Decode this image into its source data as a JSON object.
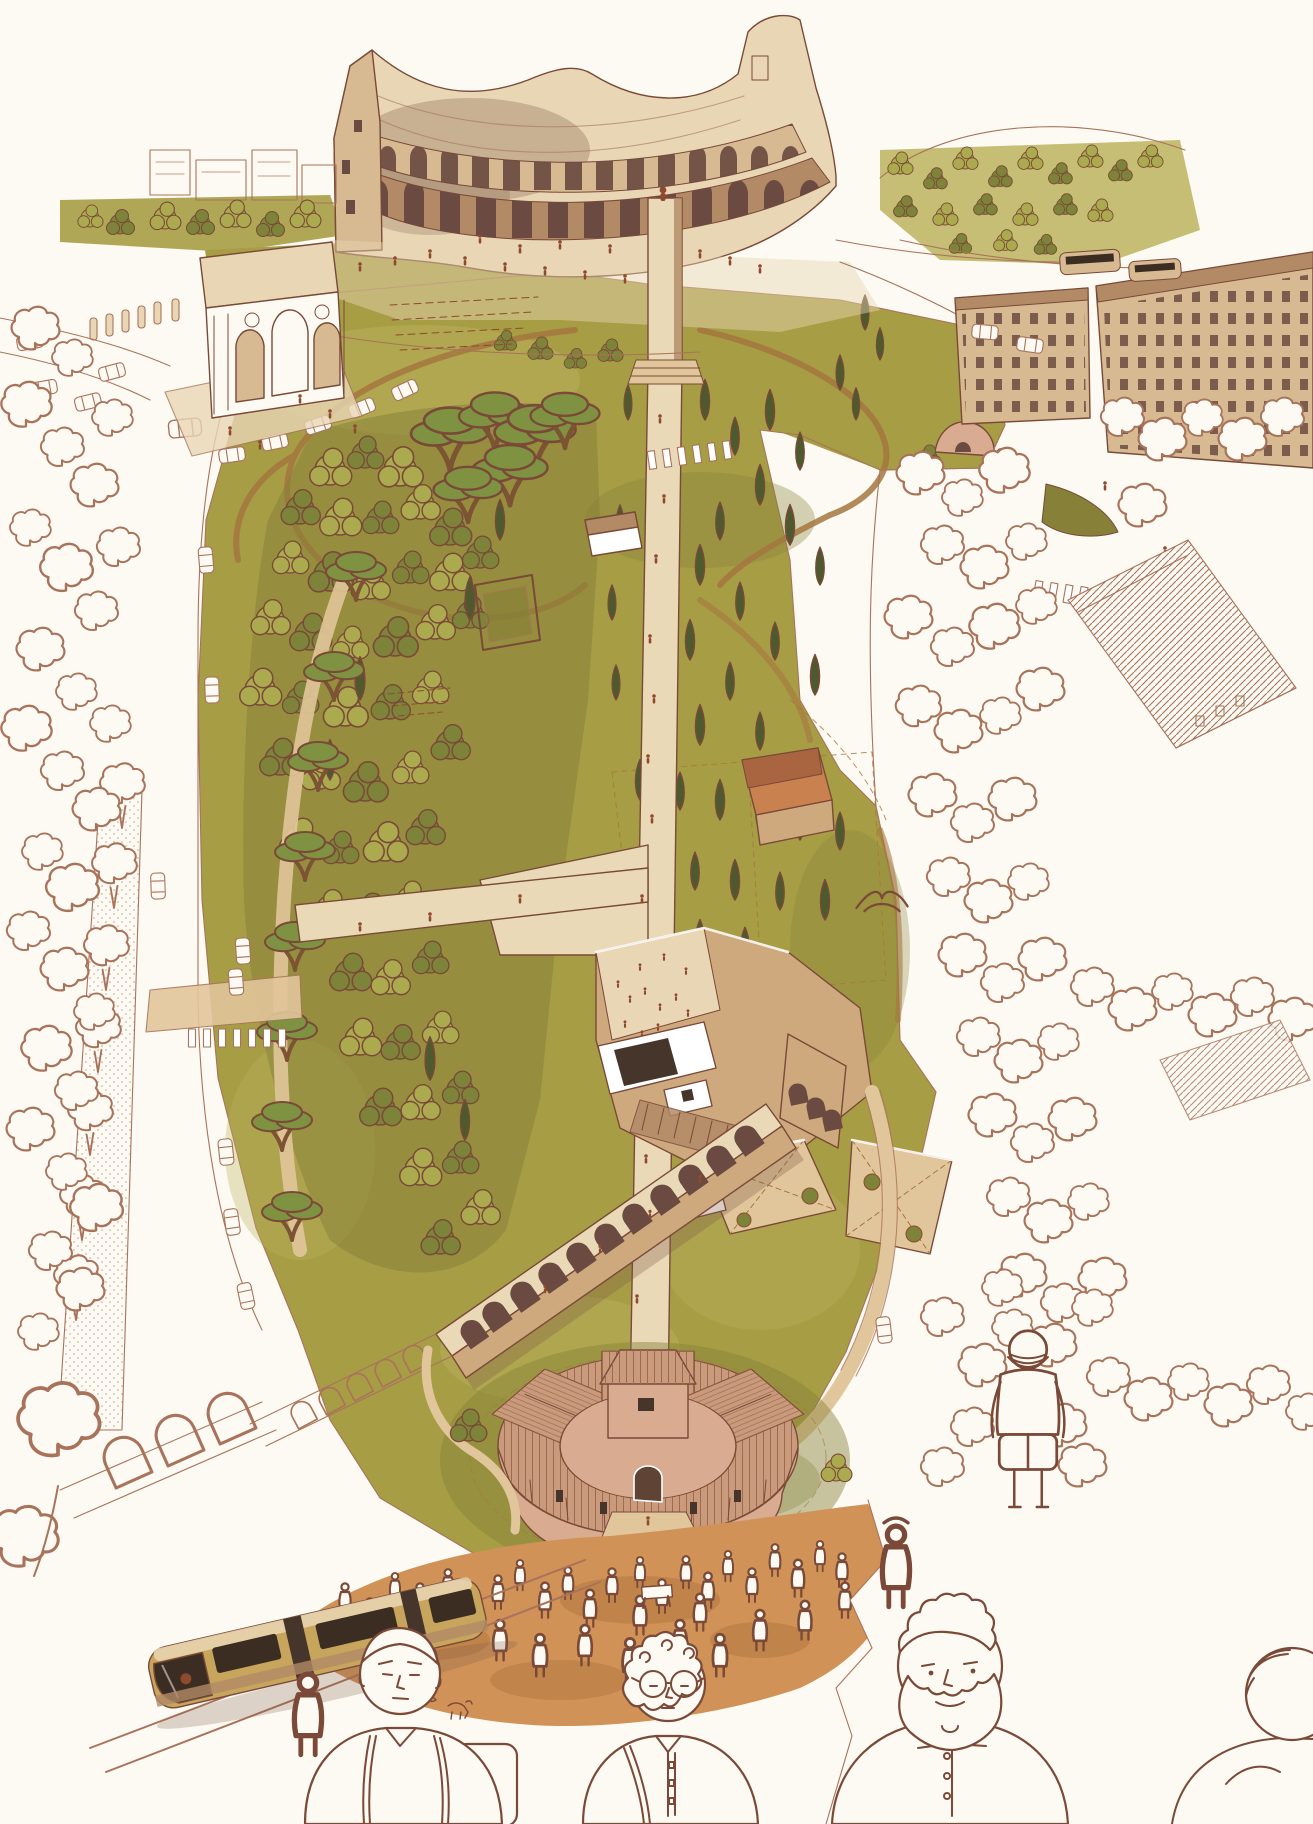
{
  "artwork": {
    "medium": "ink and watercolor aerial illustration",
    "view": "bird's-eye view, partially uncolored line art at the edges",
    "subject": "Archaeological park at the Colosseum in Rome",
    "visible_text": ""
  },
  "palette": {
    "paper": "#fcfaf2",
    "ink": "#7a4938",
    "inkL": "#a9735b",
    "stone": "#d8ba92",
    "stoneL": "#e9d6b4",
    "stoneD": "#b28a66",
    "arch": "#6b4b41",
    "smoke": "#7d5b47",
    "lawn": "#a79d45",
    "lawnL": "#bcb35e",
    "lawnD": "#868038",
    "treeL": "#abaa4f",
    "treeD": "#7d8338",
    "cyp": "#4d5a2d",
    "pine": "#7e9242",
    "trunk": "#7c5434",
    "path": "#ead9b6",
    "dirt": "#a5763f",
    "walk": "#e2c69b",
    "terr": "#cfa97e",
    "panel": "#46352a",
    "roofO": "#c98150",
    "roofOD": "#a96540",
    "chRoof": "#c99a7c",
    "chRoofD": "#a06a4f",
    "chWall": "#d9ab90",
    "door": "#5f4335",
    "grnd": "#d09257",
    "grndD": "#b0733d",
    "tram": "#c8a55c",
    "tramW": "#3b2d22",
    "rust": "#8f4a2e",
    "white": "#ffffff"
  },
  "scene": {
    "landmarks": [
      {
        "id": "colosseum",
        "label": "Colosseum amphitheatre with two arcade tiers"
      },
      {
        "id": "triumphal-arch",
        "label": "Arch of Constantine on a paved platform"
      },
      {
        "id": "city-blocks",
        "label": "City blocks, streets, crosswalks and buses top right"
      },
      {
        "id": "park",
        "label": "Celio park: olive lawns, dense woods, stone pines, cypress rows"
      },
      {
        "id": "central-walkway",
        "label": "Straight pedestrian walkway ending in a lookout tower at the Colosseum"
      },
      {
        "id": "excavation-complex",
        "label": "Terraced archaeological dig with white canopy roofs and stairs"
      },
      {
        "id": "aqueduct",
        "label": "Arched aqueduct ruin crossing the park diagonally"
      },
      {
        "id": "round-church",
        "label": "Round church with radial tiled roofs and central lantern"
      },
      {
        "id": "crowd",
        "label": "Sketched market crowd with pigeons in front of the church"
      },
      {
        "id": "tram",
        "label": "Tram arriving at the lower-left platform"
      },
      {
        "id": "foreground-figures",
        "label": "Large line-drawn pedestrians across the bottom edge"
      },
      {
        "id": "line-art-margins",
        "label": "Uncolored pen drawing of streets, trees and buildings at left and right margins"
      }
    ]
  }
}
